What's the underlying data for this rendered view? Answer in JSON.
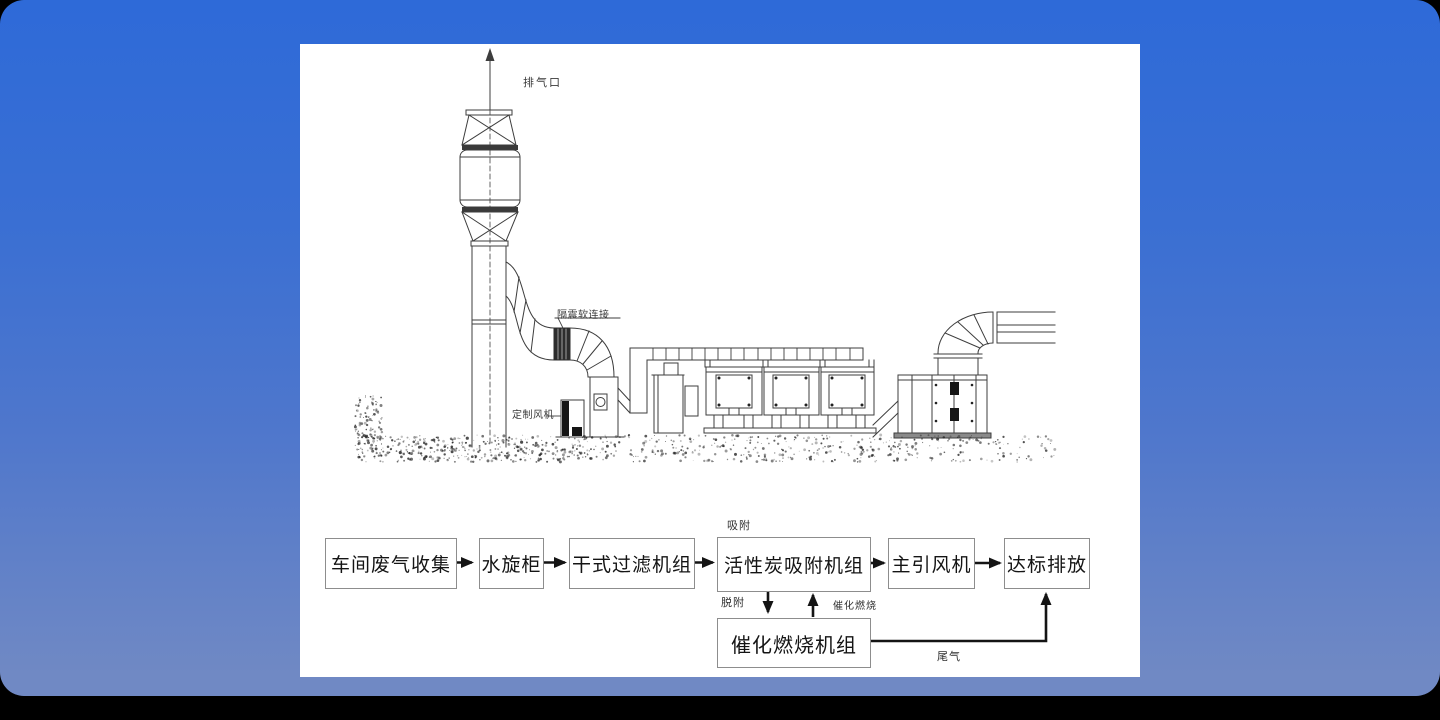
{
  "colors": {
    "background_top": "#2e6ad8",
    "background_bottom": "#7089c4",
    "panel": "#ffffff",
    "drawing_line": "#3d3d3d",
    "box_border": "#8d8d8d",
    "arrow": "#141414"
  },
  "diagram": {
    "labels": {
      "exhaust_outlet": "排气口",
      "flexible_connection": "隔震软连接",
      "custom_fan": "定制风机"
    }
  },
  "flowchart": {
    "boxes": [
      {
        "label": "车间废气收集"
      },
      {
        "label": "水旋柜"
      },
      {
        "label": "干式过滤机组"
      },
      {
        "label": "活性炭吸附机组"
      },
      {
        "label": "主引风机"
      },
      {
        "label": "达标排放"
      },
      {
        "label": "催化燃烧机组"
      }
    ],
    "edge_labels": {
      "adsorption": "吸附",
      "desorption": "脱附",
      "catalytic_combustion": "催化燃烧",
      "tail_gas": "尾气"
    }
  }
}
